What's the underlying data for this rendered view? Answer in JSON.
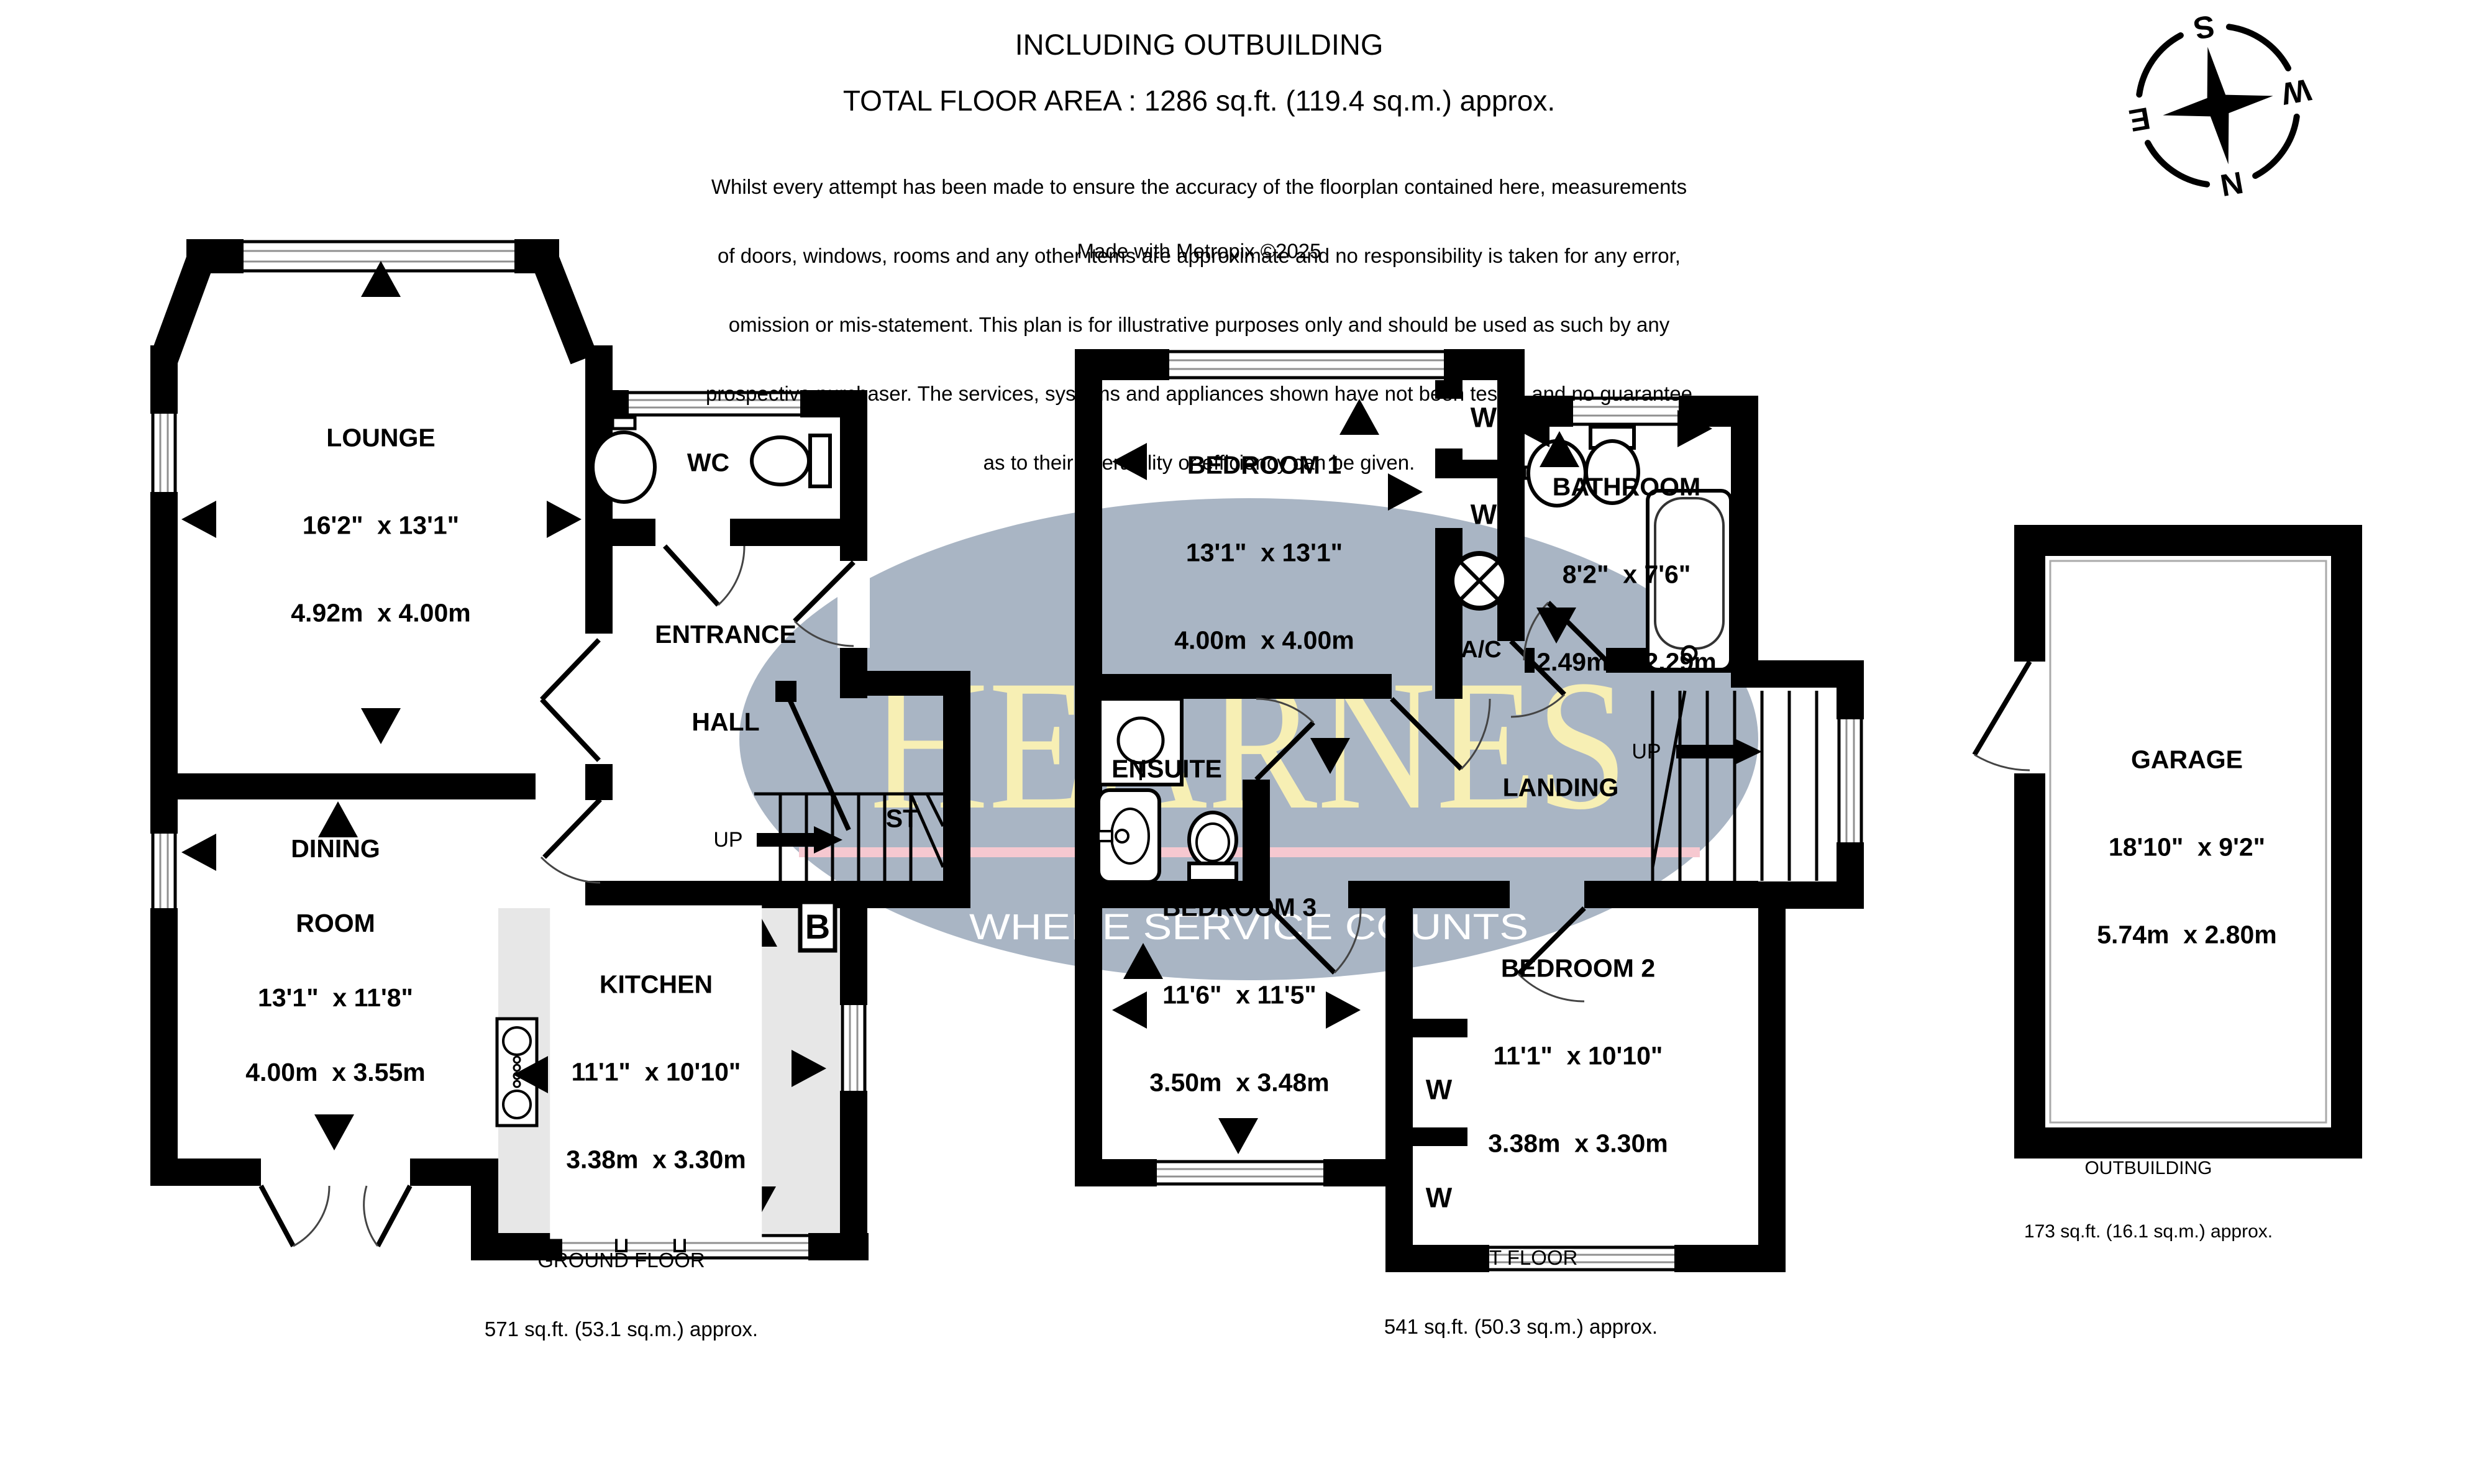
{
  "header": {
    "title": "INCLUDING OUTBUILDING",
    "total_area": "TOTAL FLOOR AREA : 1286 sq.ft. (119.4 sq.m.) approx.",
    "disclaimer_lines": [
      "Whilst every attempt has been made to ensure the accuracy of the floorplan contained here, measurements",
      "of doors, windows, rooms and any other items are approximate and no responsibility is taken for any error,",
      "omission or mis-statement. This plan is for illustrative purposes only and should be used as such by any",
      "prospective purchaser. The services, systems and appliances shown have not been tested and no guarantee",
      "as to their operability or efficiency can be given."
    ],
    "credit": "Made with Metropix ©2025"
  },
  "compass": {
    "north": "N",
    "east": "E",
    "south": "S",
    "west": "W"
  },
  "watermark": {
    "brand": "HEARNES",
    "tagline": "WHERE SERVICE COUNTS",
    "brand_color": "#f7efb4",
    "ellipse_color": "#a9b5c4",
    "underline_color": "#f6c8d0"
  },
  "floors": {
    "ground": {
      "label": "GROUND FLOOR",
      "area": "571 sq.ft. (53.1 sq.m.) approx.",
      "stairs_label": "ST",
      "up_label": "UP",
      "boiler_label": "B",
      "rooms": {
        "lounge": {
          "name": "LOUNGE",
          "imperial": "16'2\"  x 13'1\"",
          "metric": "4.92m  x 4.00m"
        },
        "wc": {
          "name": "WC"
        },
        "entrance": {
          "line1": "ENTRANCE",
          "line2": "HALL"
        },
        "dining": {
          "line1": "DINING",
          "line2": "ROOM",
          "imperial": "13'1\"  x 11'8\"",
          "metric": "4.00m  x 3.55m"
        },
        "kitchen": {
          "name": "KITCHEN",
          "imperial": "11'1\"  x 10'10\"",
          "metric": "3.38m  x 3.30m"
        }
      }
    },
    "first": {
      "label": "1ST FLOOR",
      "area": "541 sq.ft. (50.3 sq.m.) approx.",
      "up_label": "UP",
      "ac_label": "A/C",
      "wardrobe_label": "W",
      "rooms": {
        "bedroom1": {
          "name": "BEDROOM 1",
          "imperial": "13'1\"  x 13'1\"",
          "metric": "4.00m  x 4.00m"
        },
        "bathroom": {
          "name": "BATHROOM",
          "imperial": "8'2\"  x 7'6\"",
          "metric": "2.49m  x 2.29m"
        },
        "ensuite": {
          "name": "ENSUITE"
        },
        "landing": {
          "name": "LANDING"
        },
        "bedroom3": {
          "name": "BEDROOM 3",
          "imperial": "11'6\"  x 11'5\"",
          "metric": "3.50m  x 3.48m"
        },
        "bedroom2": {
          "name": "BEDROOM 2",
          "imperial": "11'1\"  x 10'10\"",
          "metric": "3.38m  x 3.30m"
        }
      }
    },
    "outbuilding": {
      "label": "OUTBUILDING",
      "area": "173 sq.ft. (16.1 sq.m.) approx.",
      "rooms": {
        "garage": {
          "name": "GARAGE",
          "imperial": "18'10\"  x 9'2\"",
          "metric": "5.74m  x 2.80m"
        }
      }
    }
  }
}
